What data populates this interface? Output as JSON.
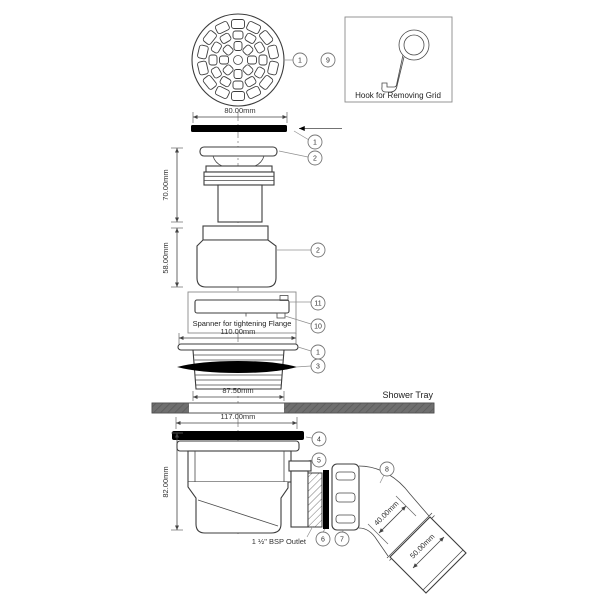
{
  "figure": {
    "notes": {
      "hook": "Hook for Removing Grid",
      "spanner": "Spanner for tightening Flange",
      "shower_tray": "Shower Tray",
      "outlet": "1 ½\" BSP Outlet"
    },
    "dimensions": {
      "grid_width": "80.00mm",
      "upper_height": "70.00mm",
      "body_height": "58.00mm",
      "flange_width": "110.00mm",
      "thread_width": "87.50mm",
      "trap_flange_width": "117.00mm",
      "trap_height": "82.00mm",
      "elbow_od": "40.00mm",
      "pipe_od": "50.00mm"
    },
    "callouts": {
      "grid_top": "1",
      "hook": "9",
      "grid_side": "1",
      "upper_flange": "2",
      "body": "2",
      "spanner": "11",
      "spanner_pin": "10",
      "screw_flange": "1",
      "gasket": "3",
      "top_seal": "4",
      "trap_body": "5",
      "washer": "6",
      "nut": "7",
      "elbow": "8"
    },
    "colors": {
      "line": "#3c3c3c",
      "black_part": "#000000",
      "tray_gray": "#6f6f6f"
    }
  }
}
